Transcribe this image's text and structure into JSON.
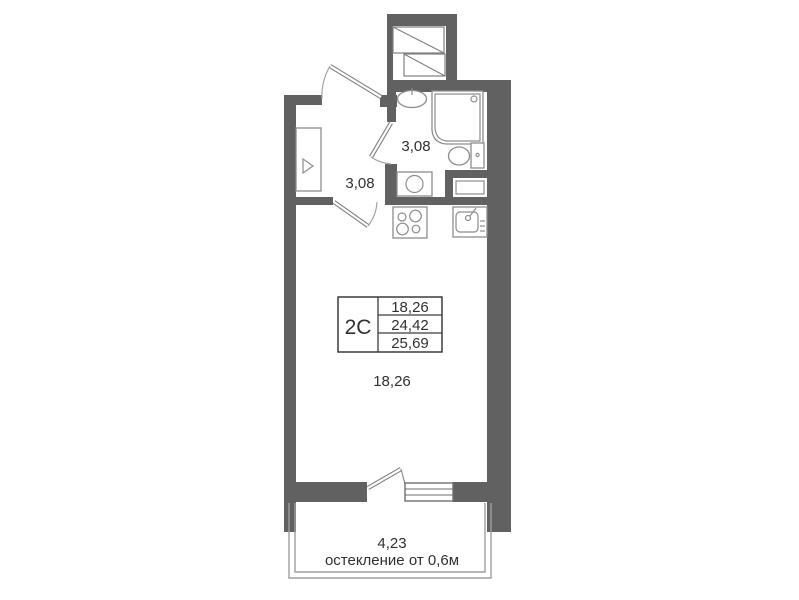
{
  "unit": {
    "type_label": "2C"
  },
  "info_table": {
    "rows": [
      "18,26",
      "24,42",
      "25,69"
    ]
  },
  "labels": {
    "hallway_area": "3,08",
    "bathroom_area": "3,08",
    "living_area": "18,26",
    "balcony_area": "4,23",
    "balcony_glazing": "остекление от 0,6м"
  },
  "colors": {
    "wall": "#616161",
    "fixture": "#8d8d8d",
    "thin_line": "#9e9e9e",
    "text": "#303030"
  }
}
